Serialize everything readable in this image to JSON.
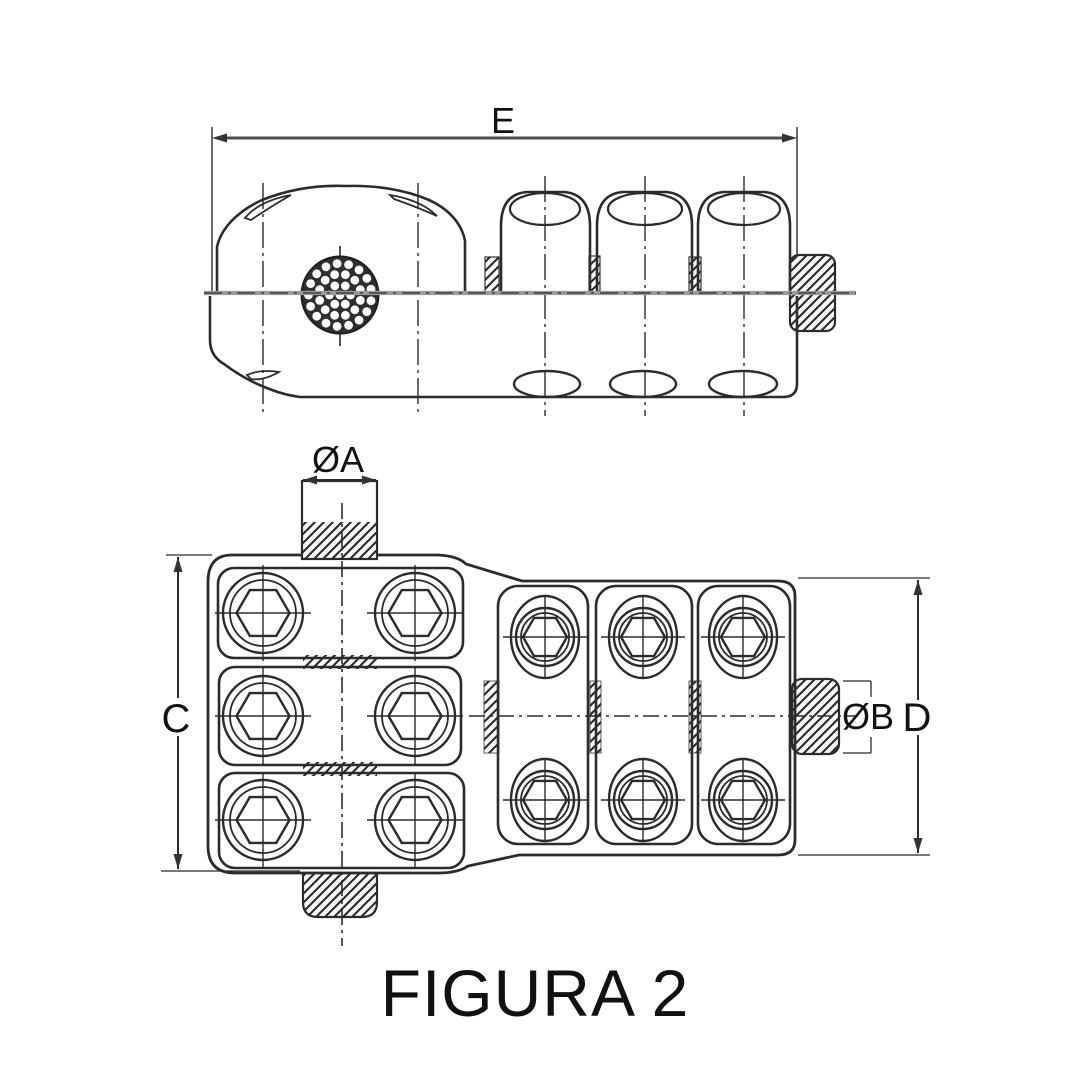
{
  "figure": {
    "caption": "FIGURA 2"
  },
  "labels": {
    "e": "E",
    "oa": "ØA",
    "c": "C",
    "ob": "ØB",
    "d": "D"
  },
  "colors": {
    "line": "#2b2b2b",
    "dim_line": "#4d4d4d",
    "centerline_gray": "#9a9a9a",
    "text": "#111111",
    "background": "#ffffff"
  }
}
